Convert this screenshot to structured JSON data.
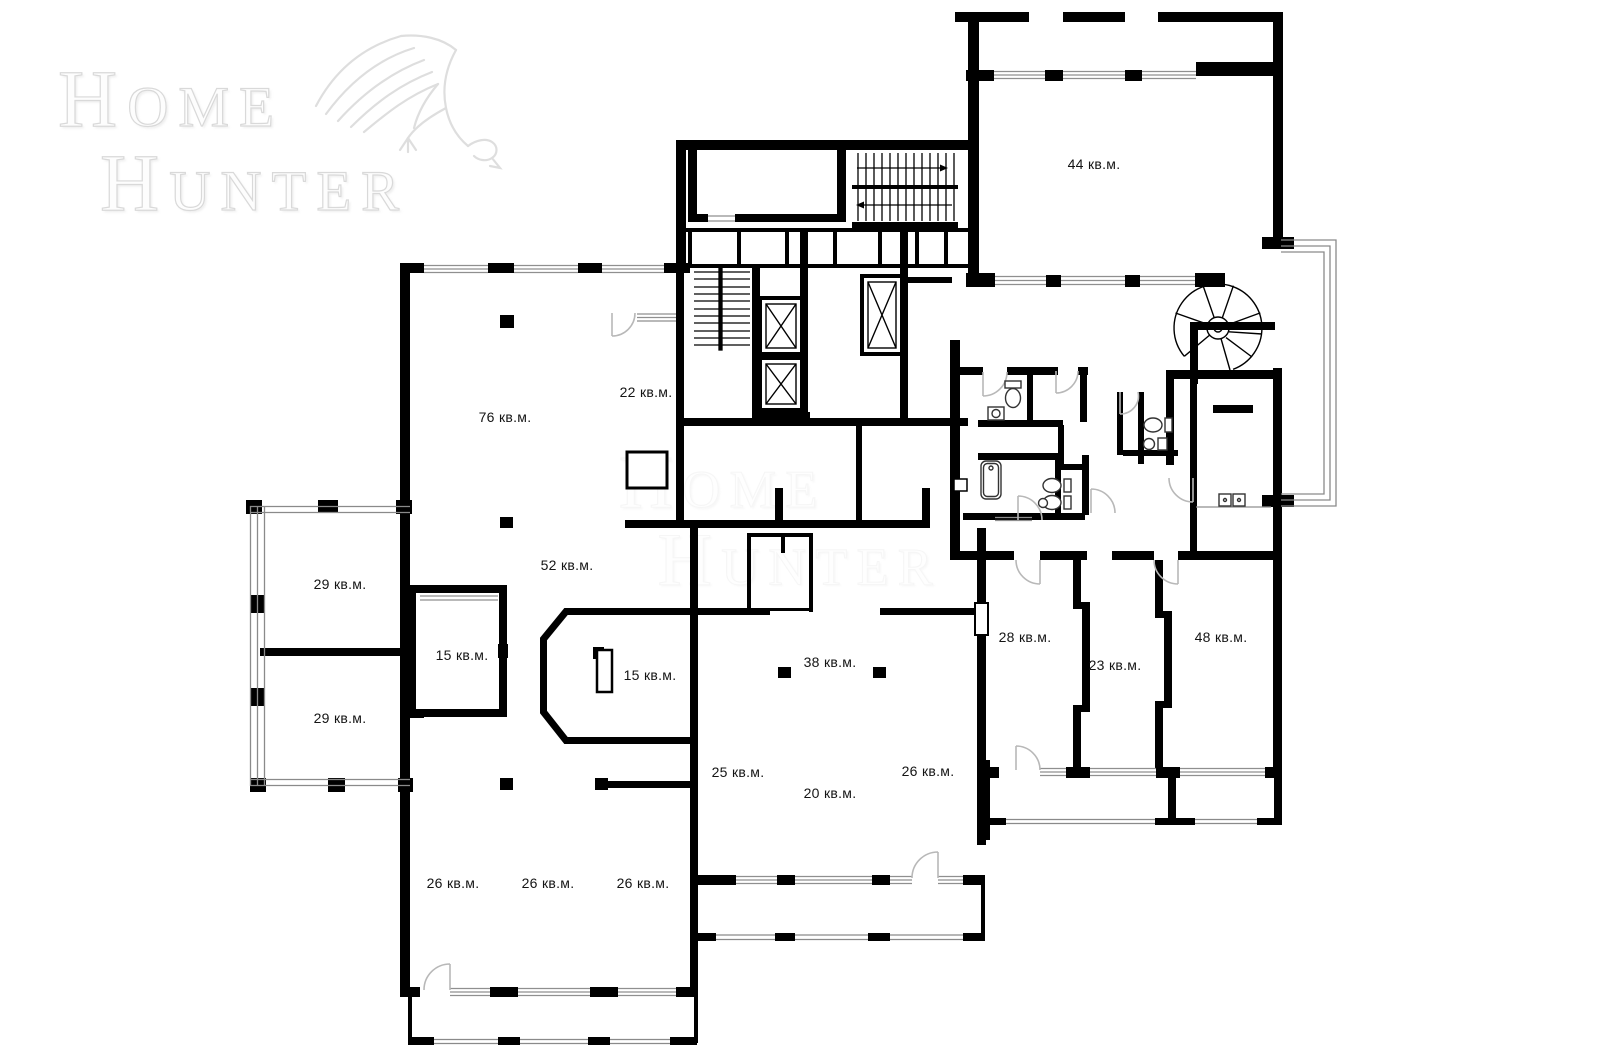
{
  "watermark": {
    "line1": "Home",
    "line2": "Hunter",
    "icon": "eagle"
  },
  "plan": {
    "unit": "кв.м.",
    "rooms": [
      {
        "name": "room-44",
        "label": "44 кв.м.",
        "x": 1094,
        "y": 164
      },
      {
        "name": "room-76",
        "label": "76 кв.м.",
        "x": 505,
        "y": 417
      },
      {
        "name": "room-22",
        "label": "22 кв.м.",
        "x": 646,
        "y": 392
      },
      {
        "name": "room-52",
        "label": "52 кв.м.",
        "x": 567,
        "y": 565
      },
      {
        "name": "terrace-29-top",
        "label": "29 кв.м.",
        "x": 340,
        "y": 584
      },
      {
        "name": "terrace-29-bottom",
        "label": "29 кв.м.",
        "x": 340,
        "y": 718
      },
      {
        "name": "room-15-left",
        "label": "15 кв.м.",
        "x": 462,
        "y": 655
      },
      {
        "name": "room-15-bay",
        "label": "15 кв.м.",
        "x": 650,
        "y": 675
      },
      {
        "name": "room-38",
        "label": "38 кв.м.",
        "x": 830,
        "y": 662
      },
      {
        "name": "room-25",
        "label": "25 кв.м.",
        "x": 738,
        "y": 772
      },
      {
        "name": "room-20",
        "label": "20 кв.м.",
        "x": 830,
        "y": 793
      },
      {
        "name": "room-26-center",
        "label": "26 кв.м.",
        "x": 928,
        "y": 771
      },
      {
        "name": "room-28",
        "label": "28 кв.м.",
        "x": 1025,
        "y": 637
      },
      {
        "name": "room-23",
        "label": "23 кв.м.",
        "x": 1115,
        "y": 665
      },
      {
        "name": "room-48",
        "label": "48 кв.м.",
        "x": 1221,
        "y": 637
      },
      {
        "name": "room-26-a",
        "label": "26 кв.м.",
        "x": 453,
        "y": 883
      },
      {
        "name": "room-26-b",
        "label": "26 кв.м.",
        "x": 548,
        "y": 883
      },
      {
        "name": "room-26-c",
        "label": "26 кв.м.",
        "x": 643,
        "y": 883
      }
    ],
    "icons": [
      "elevator-icon",
      "staircase-icon",
      "spiral-staircase-icon",
      "toilet-icon",
      "sink-icon",
      "bathtub-icon",
      "sauna-bench-icon",
      "stove-icon",
      "door-arc-icon",
      "window-band",
      "balcony-railing",
      "column-mark"
    ],
    "colors": {
      "walls": "#000000",
      "windows": "#8f8f8f",
      "doors": "#b8b8b8",
      "railing": "#8a8a8a",
      "fixtures": "#333333",
      "watermark": "#d9d9d9",
      "label_text": "#141414",
      "background": "#ffffff"
    }
  }
}
